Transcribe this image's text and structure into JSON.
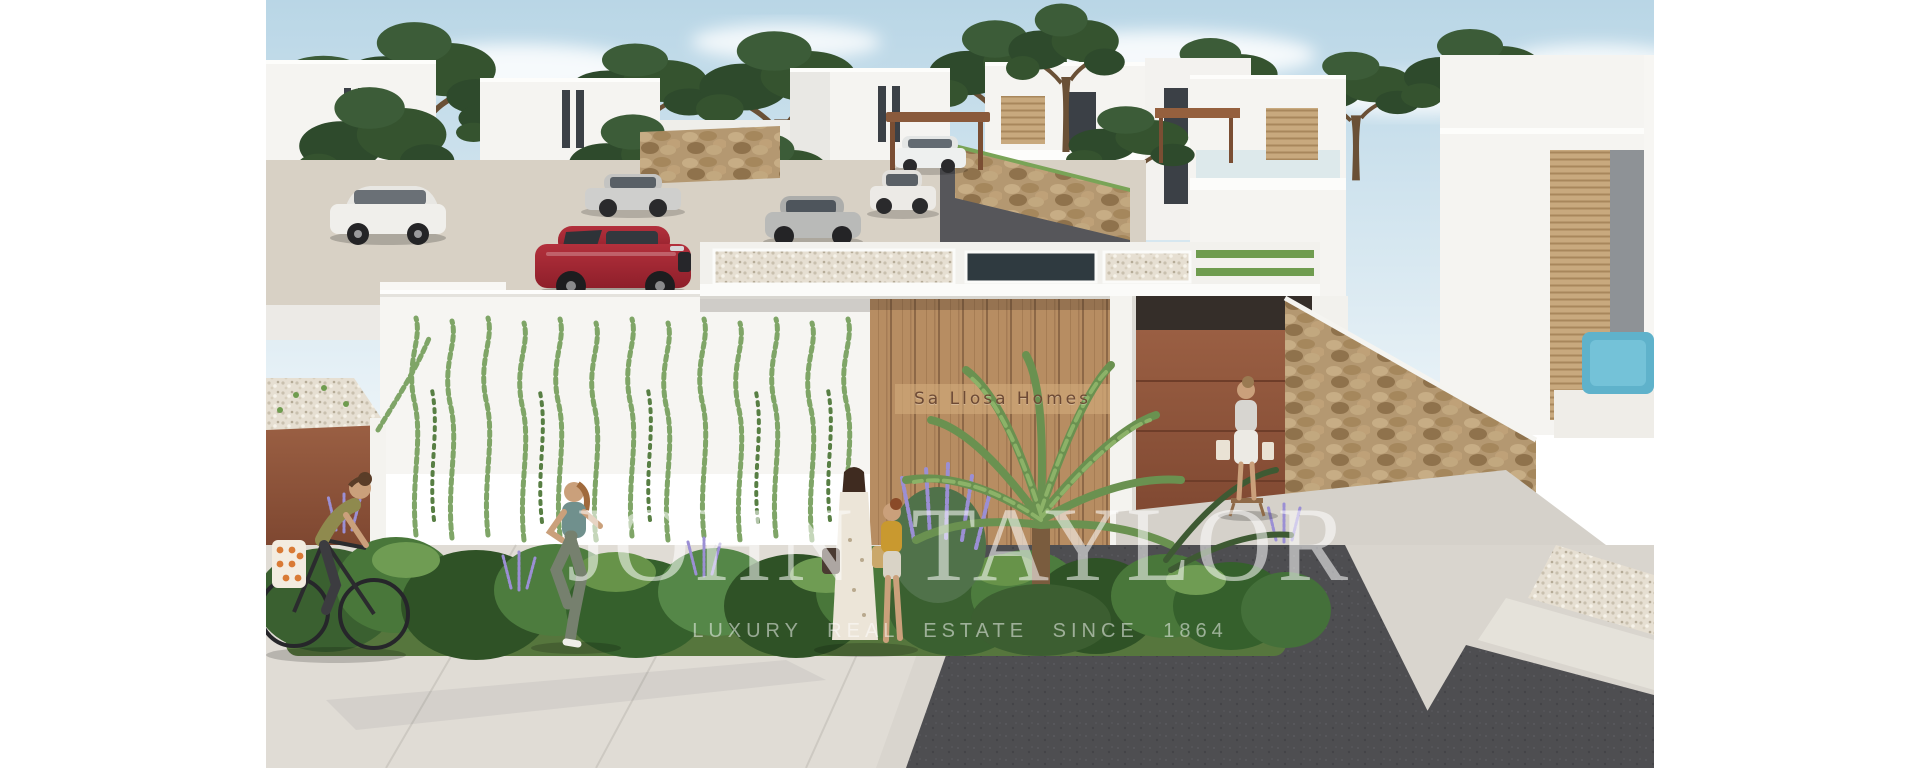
{
  "page": {
    "background": "#ffffff",
    "description": "Architectural 3D rendering of the Sa Llosa Homes residential development: white modern villas among umbrella pines, parked cars, a landscaped entrance wall with climbing ivy, wooden sign panel, corten garage doors, dry-stone walls and people on the street"
  },
  "photo": {
    "width_px": 1388,
    "height_px": 768,
    "offset_left_px": 266
  },
  "entrance_sign": {
    "text": "Sa Llosa Homes",
    "surface": "vertical wood plank panel",
    "text_color": "#6d4a35",
    "band_color": "#d2ab7c"
  },
  "watermark": {
    "brand": "JOHN TAYLOR",
    "tagline": "LUXURY REAL ESTATE SINCE 1864",
    "color": "rgba(255,255,255,0.55)"
  },
  "palette": {
    "sky_top": "#b9d6e6",
    "sky_bottom": "#ecf4f8",
    "pine_green": "#2e4a2c",
    "villa_white": "#f5f4f1",
    "wood_panel": "#b78d62",
    "corten_brown": "#8a5138",
    "stone_wall": "#b49871",
    "red_car": "#a8242e",
    "asphalt": "#4e4e51",
    "sidewalk": "#d9d5ce",
    "hedge_green": "#46703a",
    "lavender": "#9b8fd4",
    "pool_blue": "#5fb2cb"
  },
  "scene_objects": [
    "white modern villas",
    "umbrella pine trees",
    "white SUV",
    "silver sedan",
    "red SUV",
    "grey sedan",
    "white sedan",
    "wood pergola carport",
    "dry-stone walls",
    "corten garage door",
    "wooden entrance panel with sign",
    "climbing ivy green wall",
    "palm and shrubs with lavender",
    "cyclist with pannier bags",
    "jogging woman",
    "pedestrians with child",
    "woman standing by stone wall",
    "swimming pool",
    "asphalt driveway",
    "concrete sidewalk"
  ]
}
